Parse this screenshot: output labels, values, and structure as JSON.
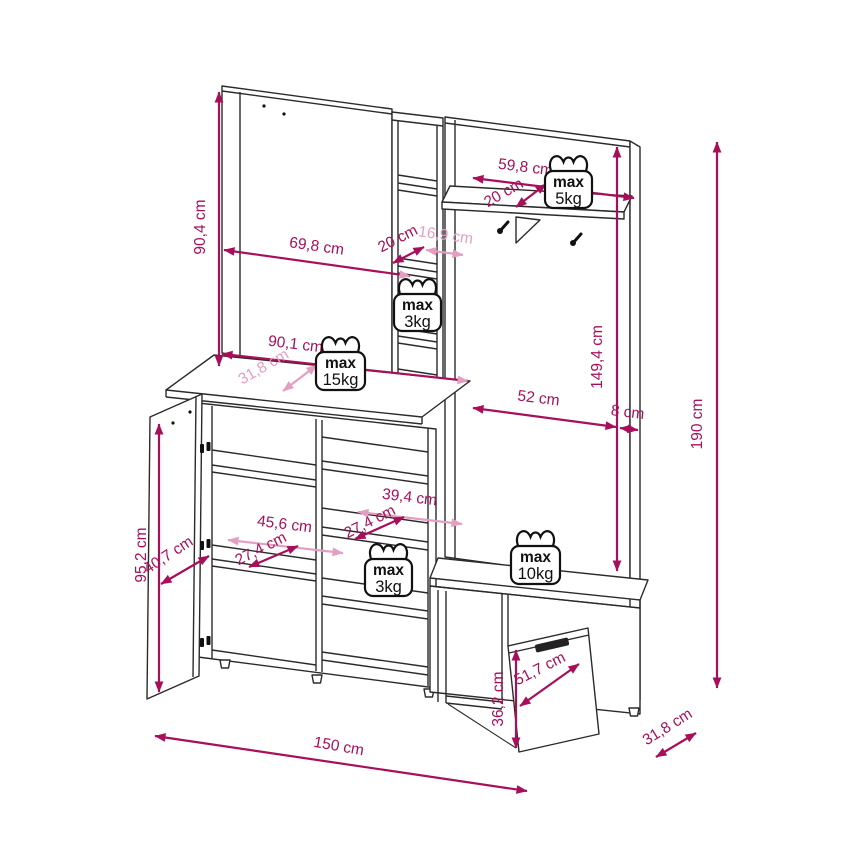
{
  "colors": {
    "dim_primary": "#A80F5A",
    "dim_secondary": "#E39FC2",
    "outline": "#2b2b2b",
    "background": "#FFFFFF",
    "badge_text": "#111111"
  },
  "dims": {
    "back_panel_height": "90,4 cm",
    "back_panel_width": "69,8 cm",
    "column_depth": "20 cm",
    "column_width": "16,9 cm",
    "coat_shelf_width": "59,8 cm",
    "coat_shelf_depth": "20 cm",
    "right_panel_height": "149,4 cm",
    "total_height": "190 cm",
    "cabinet_top_width": "90,1 cm",
    "cabinet_top_depth": "31,8 cm",
    "niche_width": "52 cm",
    "side_gap": "8 cm",
    "mid_shelf_width": "39,4 cm",
    "mid_shelf_depth": "27,4 cm",
    "left_shelf_width": "45,6 cm",
    "left_shelf_depth": "27,4 cm",
    "door_width": "40,7 cm",
    "cabinet_height": "95,2 cm",
    "flap_width": "51,7 cm",
    "flap_height": "36,2 cm",
    "total_width": "150 cm",
    "total_depth": "31,8 cm"
  },
  "load_limits": {
    "coat_shelf": {
      "label": "max",
      "value": "5kg"
    },
    "column_shelf": {
      "label": "max",
      "value": "3kg"
    },
    "cabinet_top": {
      "label": "max",
      "value": "15kg"
    },
    "mid_shelf": {
      "label": "max",
      "value": "3kg"
    },
    "bench": {
      "label": "max",
      "value": "10kg"
    }
  }
}
